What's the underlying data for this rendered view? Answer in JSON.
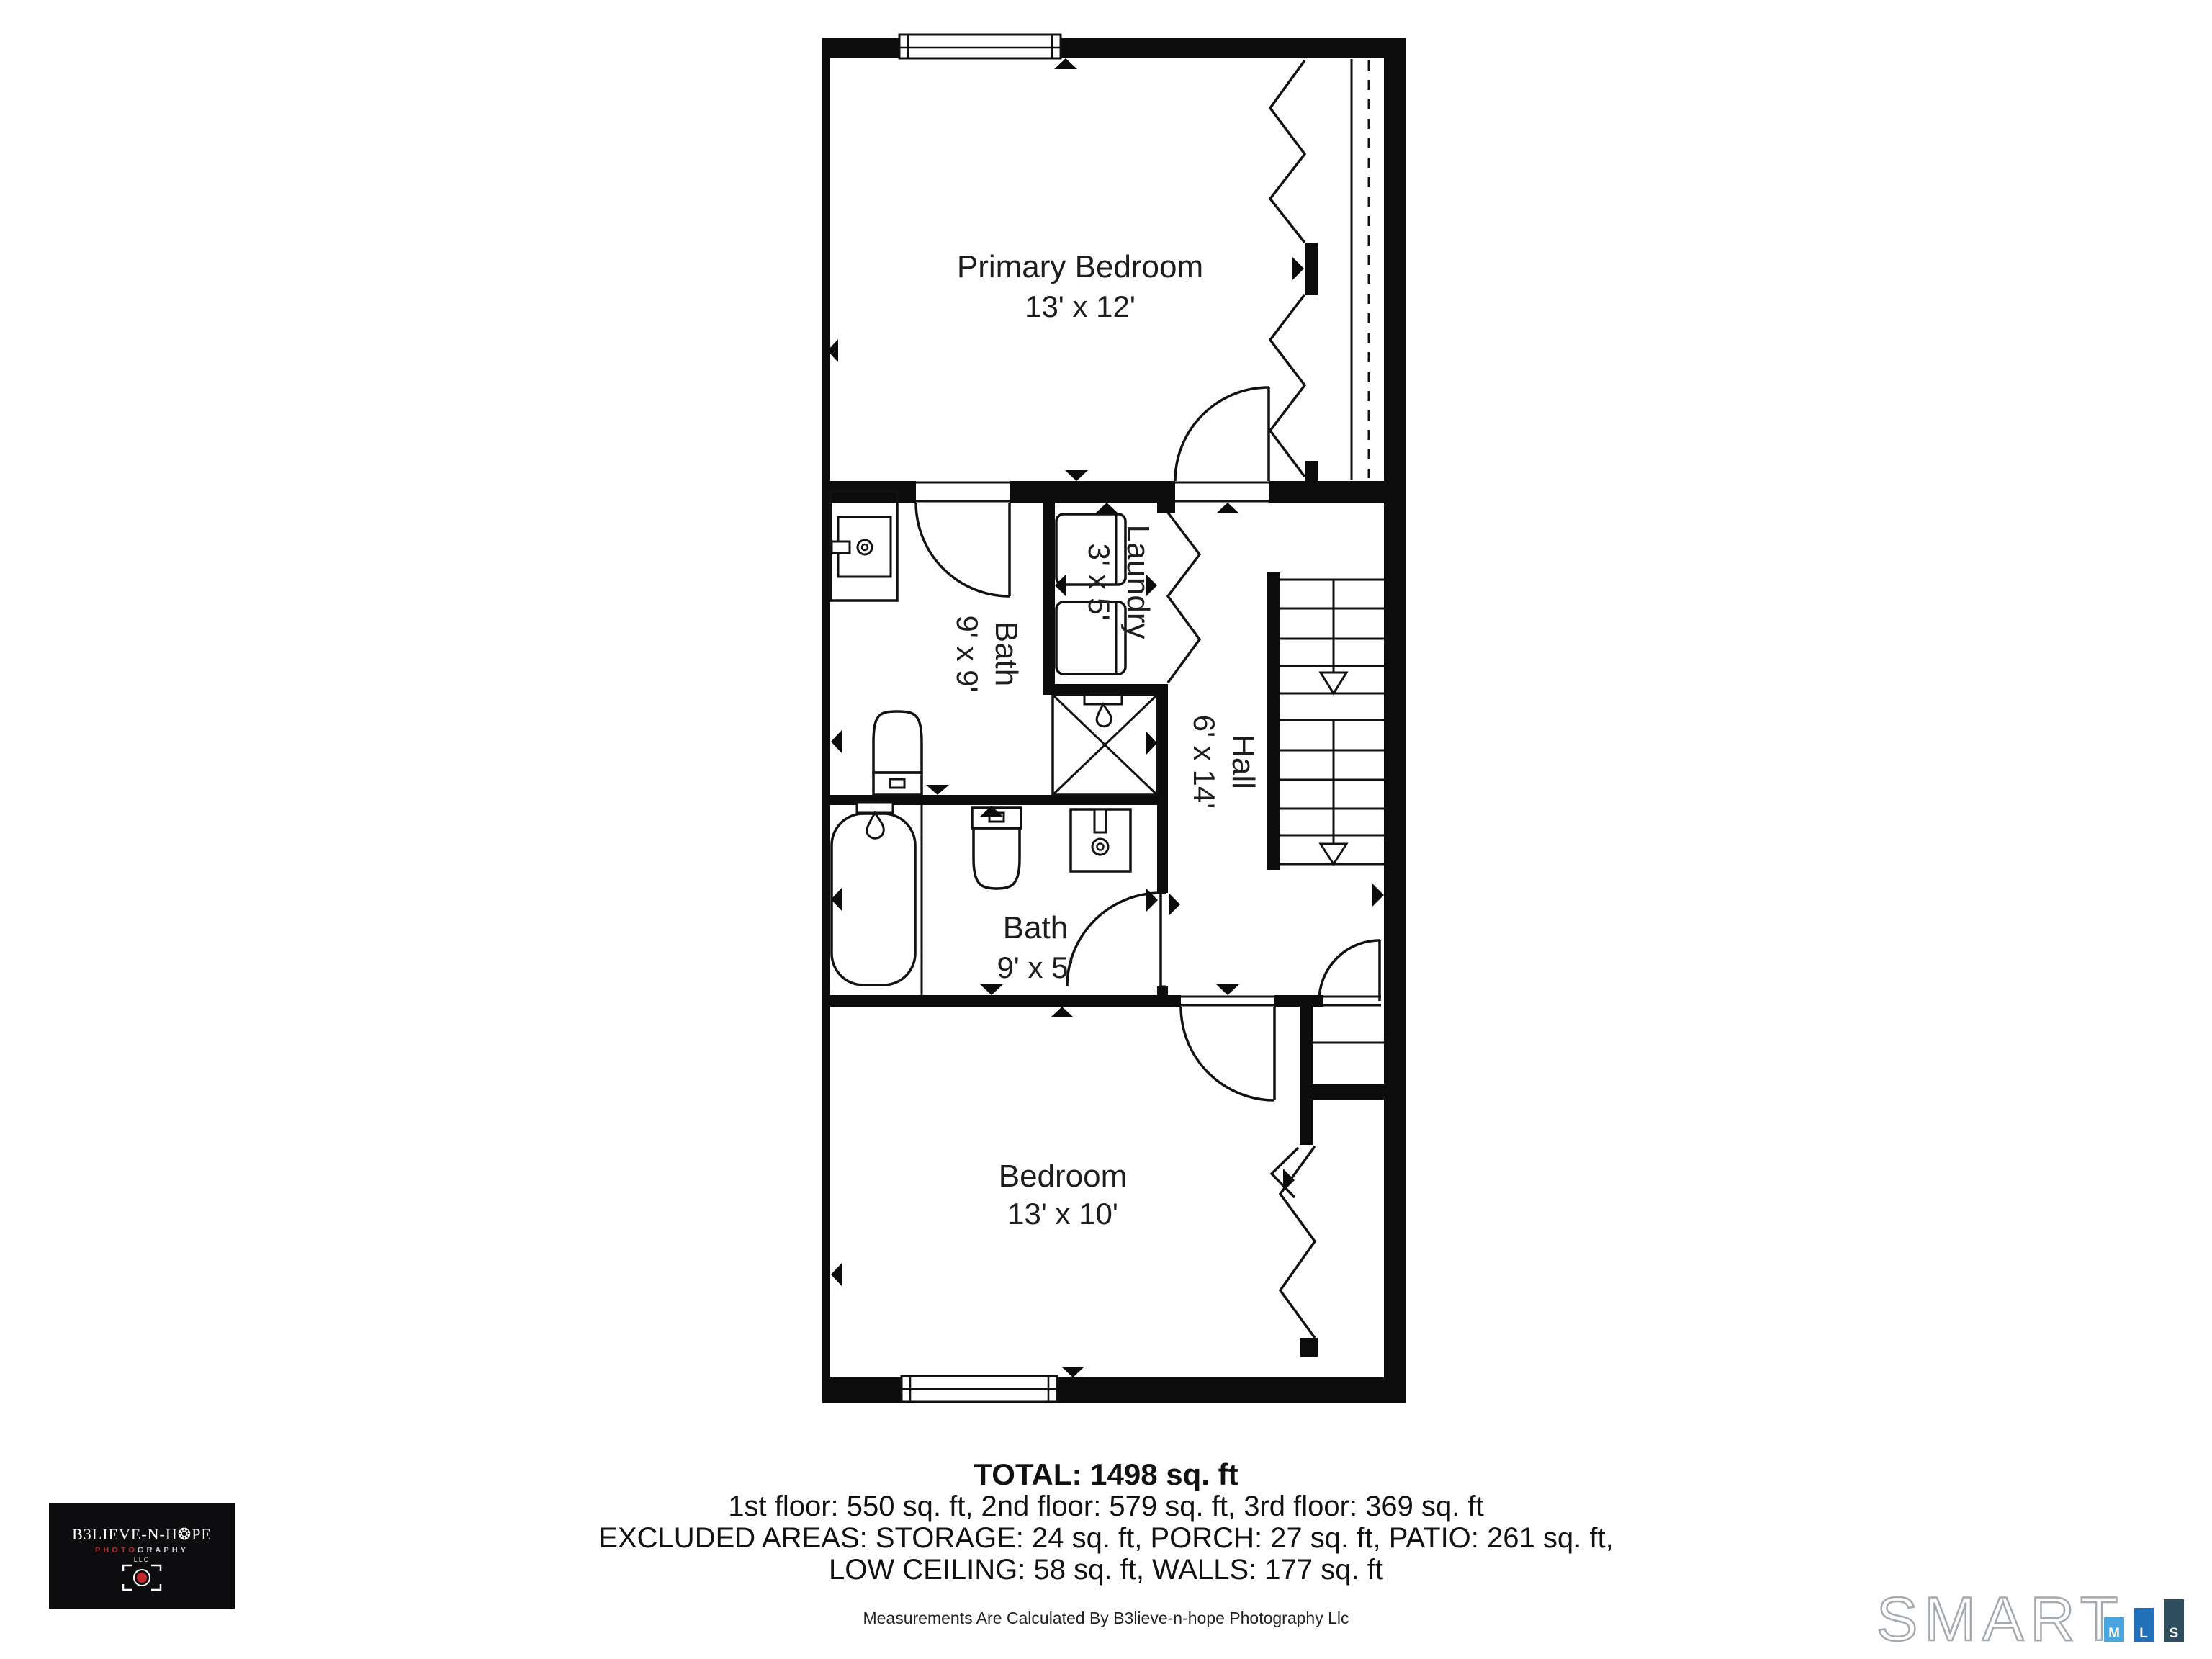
{
  "floor_plan": {
    "title_implicit": "3rd floor plan",
    "rooms": [
      {
        "name": "Primary Bedroom",
        "dims": "13' x 12'"
      },
      {
        "name": "Bath",
        "dims": "9' x 9'"
      },
      {
        "name": "Laundry",
        "dims": "3' x 5'"
      },
      {
        "name": "Hall",
        "dims": "6' x 14'"
      },
      {
        "name": "Bath",
        "dims": "9' x 5'"
      },
      {
        "name": "Bedroom",
        "dims": "13' x 10'"
      }
    ],
    "fixtures": [
      "sink-vanity",
      "toilet",
      "shower",
      "bathtub",
      "washer",
      "dryer",
      "stairs-down",
      "closet-bifold-doors",
      "windows",
      "doors"
    ]
  },
  "summary": {
    "total": "TOTAL: 1498 sq. ft",
    "floors": "1st floor: 550 sq. ft, 2nd floor: 579 sq. ft, 3rd floor: 369 sq. ft",
    "excluded_line1": "EXCLUDED AREAS: STORAGE: 24 sq. ft, PORCH: 27 sq. ft, PATIO: 261 sq. ft,",
    "excluded_line2": "LOW CEILING: 58 sq. ft, WALLS: 177 sq. ft",
    "disclaimer": "Measurements Are Calculated By B3lieve-n-hope Photography Llc"
  },
  "photographer_logo": {
    "brand": "B3LIEVE-N-H❂PE",
    "photo": "PHOTO",
    "graphy": "GRAPHY",
    "llc": "LLC",
    "background": "#0d0d0f",
    "accent_red": "#c2272d"
  },
  "mls_logo": {
    "smart": "SMART",
    "tiles": [
      {
        "letter": "M",
        "color": "#49a5de"
      },
      {
        "letter": "L",
        "color": "#2171b8"
      },
      {
        "letter": "S",
        "color": "#2e4d5e"
      }
    ],
    "outline_color": "#a3aaaf"
  }
}
